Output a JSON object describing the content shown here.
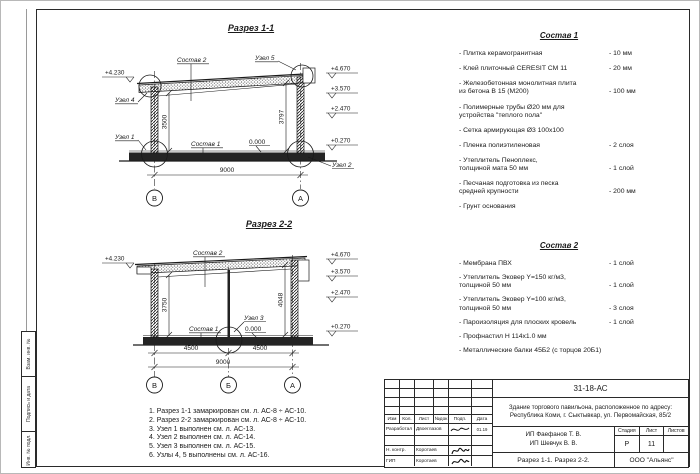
{
  "side_labels": [
    "Взам. инв. №",
    "Подпись и дата",
    "Инв. № подл."
  ],
  "section1": {
    "title": "Разрез 1-1",
    "label_sostav2": "Состав 2",
    "label_sostav1": "Состав 1",
    "uzel1": "Узел 1",
    "uzel2": "Узел 2",
    "uzel4": "Узел 4",
    "uzel5": "Узел 5",
    "zero": "0.000",
    "elev_left": "+4.230",
    "elev_right": [
      "+4.670",
      "+3.570",
      "+2.470",
      "+0.270"
    ],
    "dim_width": "9000",
    "dim_h_left": "3500",
    "dim_h_right": "3797",
    "axes": [
      "В",
      "А"
    ]
  },
  "section2": {
    "title": "Разрез 2-2",
    "label_sostav2": "Состав 2",
    "label_sostav1": "Состав 1",
    "uzel3": "Узел 3",
    "zero": "0.000",
    "elev_left": "+4.230",
    "elev_right": [
      "+4.670",
      "+3.570",
      "+2.470",
      "+0.270"
    ],
    "dim_span1": "4500",
    "dim_span2": "4500",
    "dim_width": "9000",
    "dim_h_left": "3750",
    "dim_h_right": "4048",
    "axes": [
      "В",
      "Б",
      "А"
    ]
  },
  "comp1": {
    "title": "Состав 1",
    "items": [
      {
        "name": "- Плитка керамогранитная",
        "value": "- 10 мм"
      },
      {
        "name": "- Клей плиточный CERESIT CM 11",
        "value": "- 20 мм"
      },
      {
        "name": "- Железобетонная  монолитная плита\nиз бетона В 15 (М200)",
        "value": "- 100 мм"
      },
      {
        "name": "- Полимерные трубы Ø20 мм для\nустройства \"теплого пола\"",
        "value": ""
      },
      {
        "name": "- Сетка армирующая Ø3 100х100",
        "value": ""
      },
      {
        "name": "- Пленка полиэтиленовая",
        "value": "- 2 слоя"
      },
      {
        "name": "- Утеплитель Пеноплекс,\nтолщиной мата 50 мм",
        "value": "- 1 слой"
      },
      {
        "name": "- Песчаная подготовка из песка\nсредней крупности",
        "value": "- 200 мм"
      },
      {
        "name": "- Грунт основания",
        "value": ""
      }
    ]
  },
  "comp2": {
    "title": "Состав 2",
    "items": [
      {
        "name": "- Мембрана ПВХ",
        "value": "- 1 слой"
      },
      {
        "name": "- Утеплитель Эковер Y=150 кг/м3,\nтолщиной 50 мм",
        "value": "- 1 слой"
      },
      {
        "name": "- Утеплитель Эковер Y=100 кг/м3,\nтолщиной 50 мм",
        "value": "- 3 слоя"
      },
      {
        "name": "- Пароизоляция для плоских кровель",
        "value": "- 1 слой"
      },
      {
        "name": "- Профнастил Н 114х1.0 мм",
        "value": ""
      },
      {
        "name": "- Металлические балки 45Б2 (с торцов 20Б1)",
        "value": ""
      }
    ]
  },
  "notes": [
    "1. Разрез 1-1 замаркирован см. л. АС-8 ÷ АС-10.",
    "2. Разрез 2-2 замаркирован см. л. АС-8 ÷ АС-10.",
    "3. Узел 1 выполнен см. л. АС-13.",
    "4. Узел 2 выполнен см. л. АС-14.",
    "5. Узел 3 выполнен см. л. АС-15.",
    "6. Узлы 4, 5 выполнены см. л. АС-16."
  ],
  "titleblock": {
    "doc_number": "31-18-АС",
    "object": "Здание торгового павильона, расположенное по адресу: Республика Коми, г. Сыктывкар, ул. Первомайская, 85/2",
    "cols": [
      "Изм",
      "Кол.",
      "Лист",
      "№док",
      "Подп.",
      "Дата"
    ],
    "sign_rows": [
      {
        "role": "Разработал",
        "name": "Двоеглазов",
        "date": "01.19"
      },
      {
        "role": "Н. контр.",
        "name": "Коротаев",
        "date": ""
      },
      {
        "role": "ГИП",
        "name": "Коротаев",
        "date": ""
      }
    ],
    "client_line1": "ИП Фаефанов Т. В.",
    "client_line2": "ИП Шевчук В. В.",
    "stage_label": "Стадия",
    "sheet_label": "Лист",
    "sheets_label": "Листов",
    "stage": "Р",
    "sheet_no": "11",
    "sheets_total": "",
    "drawing_title": "Разрез 1-1. Разрез 2-2.",
    "company": "ООО \"Альянс\""
  }
}
